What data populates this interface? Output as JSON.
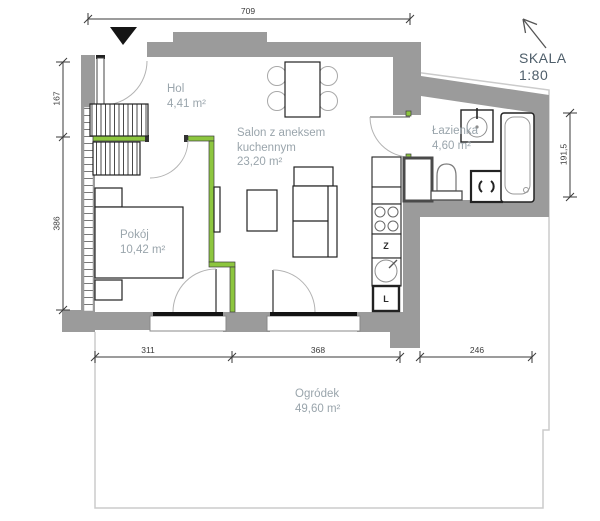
{
  "scale": {
    "label": "SKALA",
    "value": "1:80"
  },
  "rooms": {
    "hol": {
      "name": "Hol",
      "area": "4,41 m²"
    },
    "salon": {
      "name_line1": "Salon z aneksem",
      "name_line2": "kuchennym",
      "area": "23,20 m²"
    },
    "pokoj": {
      "name": "Pokój",
      "area": "10,42 m²"
    },
    "lazienka": {
      "name": "Łazienka",
      "area": "4,60 m²"
    },
    "ogrodek": {
      "name": "Ogródek",
      "area": "49,60 m²"
    }
  },
  "dimensions_cm": {
    "top": "709",
    "left_upper": "167",
    "left_lower": "386",
    "right": "191,5",
    "bottom_left": "311",
    "bottom_center": "368",
    "bottom_right": "246"
  },
  "kitchen_appliances": {
    "dishwasher_label": "Z",
    "fridge_label": "L"
  },
  "colors": {
    "wall_gray": "#9b9b9b",
    "highlight_green": "#8dc63f",
    "room_label_gray": "#9aa5ac",
    "scale_text": "#4e5e6a",
    "dimension_text": "#3b3b3b",
    "glass_black": "#141414",
    "garden_boundary": "#cbcbcb"
  }
}
